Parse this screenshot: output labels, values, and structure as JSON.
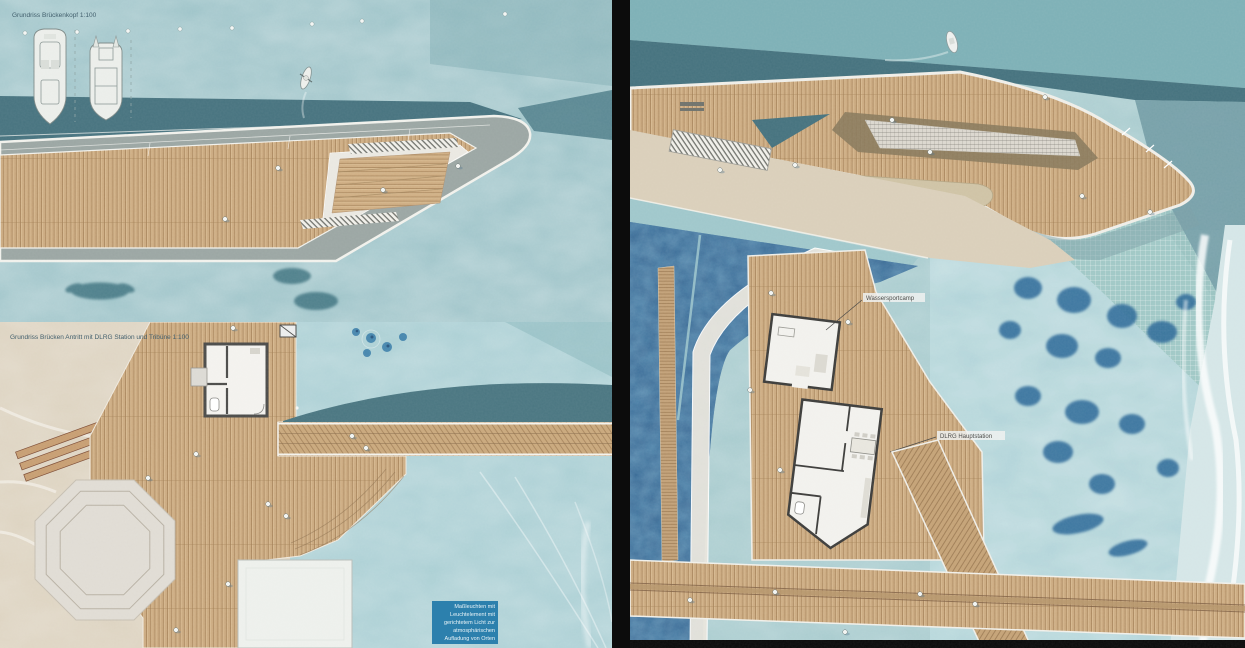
{
  "left_panel": {
    "top_plan": {
      "title": "Grundriss Brückenkopf 1:100"
    },
    "bottom_plan": {
      "title": "Grundriss Brücken Antritt mit DLRG Station und Tribüne 1:100"
    },
    "annotation": {
      "lines": [
        "Maßleuchten mit",
        "Leuchtelement mit",
        "gerichtetem Licht zur",
        "atmosphärischen",
        "Aufladung von Orten"
      ]
    }
  },
  "right_panel": {
    "labels": {
      "camp": "Wassersportcamp",
      "station": "DLRG Hauptstation"
    }
  },
  "colors": {
    "water_light": "#9dc3c8",
    "water_teal_dark": "#47737f",
    "water_navy": "#31628f",
    "wood": "#cbaa80",
    "sand": "#dcd2bf",
    "concrete": "#9ba6a3",
    "platform_gray": "#e0dcd4",
    "annotation_bg": "#2c80ad",
    "divider": "#0c0c0c"
  }
}
